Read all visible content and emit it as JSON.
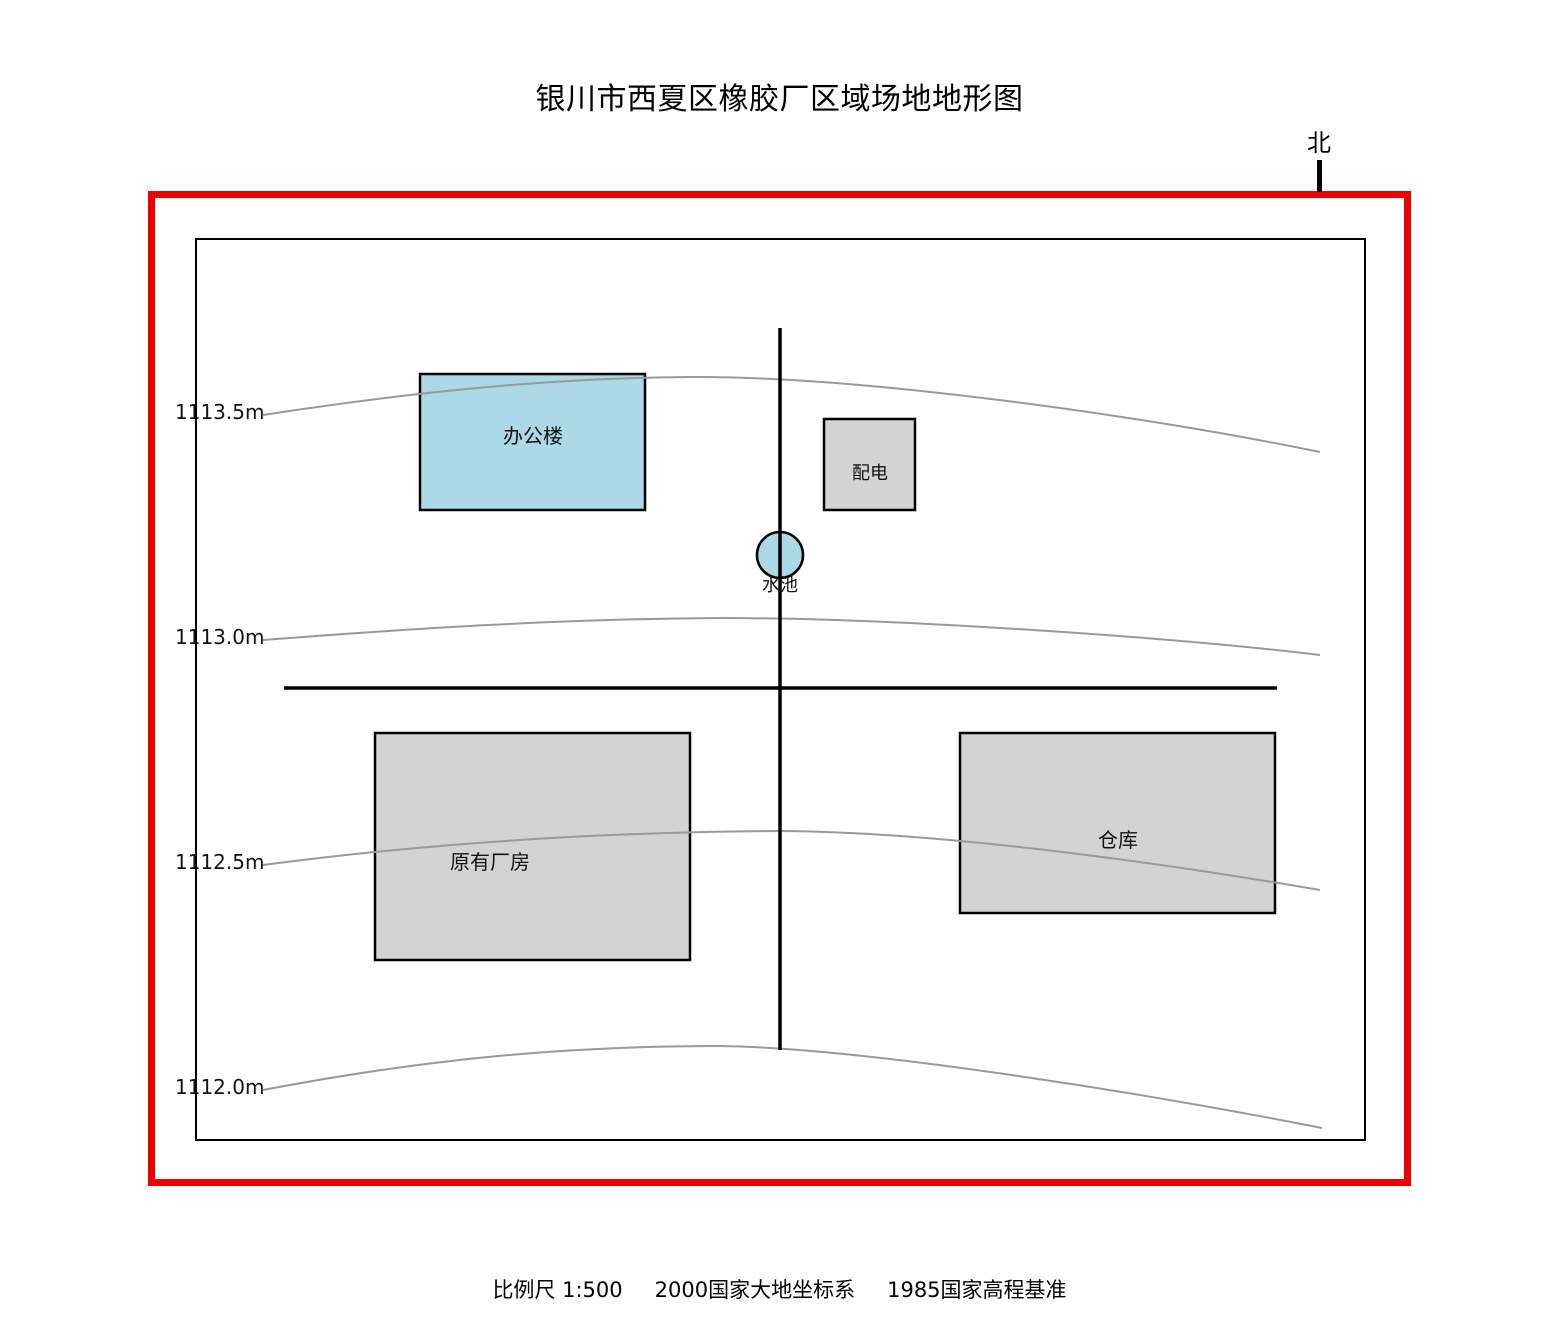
{
  "title": "银川市西夏区橡胶厂区域场地地形图",
  "north": {
    "label": "北"
  },
  "contours": [
    {
      "elevation": "1113.5m"
    },
    {
      "elevation": "1113.0m"
    },
    {
      "elevation": "1112.5m"
    },
    {
      "elevation": "1112.0m"
    }
  ],
  "features": {
    "office": "办公楼",
    "power": "配电",
    "pool": "水池",
    "factory": "原有厂房",
    "warehouse": "仓库"
  },
  "footer": {
    "scale": "比例尺 1:500",
    "coordinate_system": "2000国家大地坐标系",
    "elevation_datum": "1985国家高程基准"
  },
  "colors": {
    "boundary_red": "#ee0000",
    "water_blue": "#add8e6",
    "building_gray": "#d3d3d3",
    "contour_gray": "#999999",
    "line_black": "#000000"
  }
}
